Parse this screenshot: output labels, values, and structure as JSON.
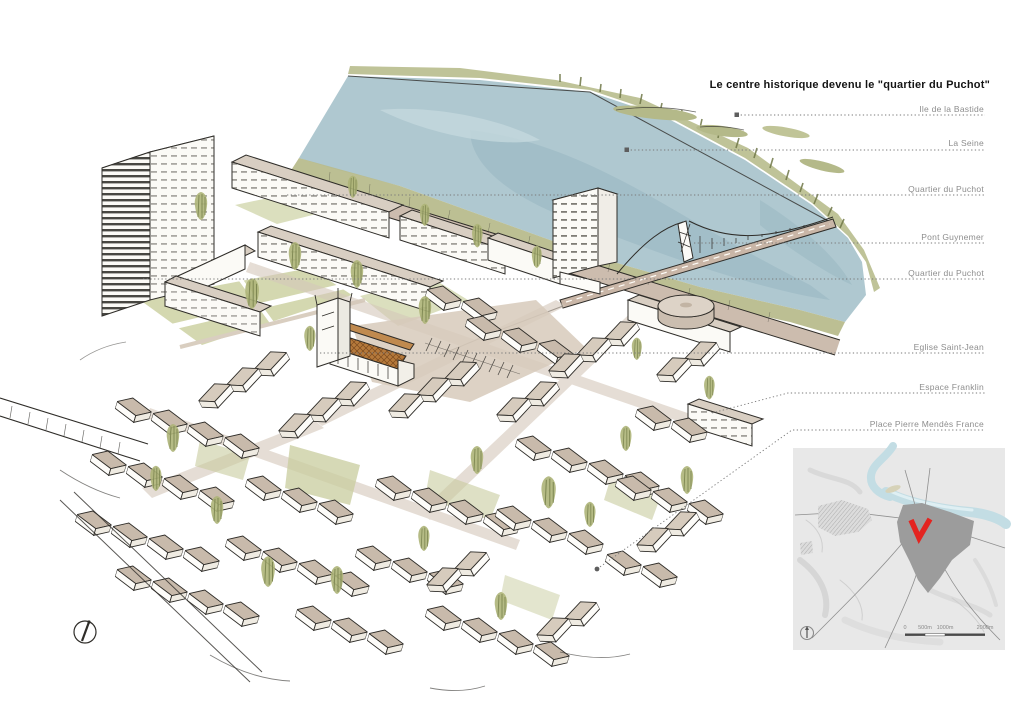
{
  "title": "Le centre historique devenu le \"quartier du Puchot\"",
  "labels": [
    {
      "text": "Ile de la Bastide"
    },
    {
      "text": "La Seine"
    },
    {
      "text": "Quartier du Puchot"
    },
    {
      "text": "Pont Guynemer"
    },
    {
      "text": "Quartier du Puchot"
    },
    {
      "text": "Eglise Saint-Jean"
    },
    {
      "text": "Espace Franklin"
    },
    {
      "text": "Place Pierre Mendès France"
    }
  ],
  "minimap": {
    "scale_labels": [
      "0",
      "500m",
      "1000m",
      "2000m"
    ],
    "marker_color": "#e32420"
  },
  "colors": {
    "ink": "#2f2d29",
    "water": "#afc8d0",
    "vegetation": "#b5ba8b",
    "roof": "#c8baab",
    "church_roof": "#b5793b",
    "label_gray": "#8d8d8d"
  }
}
